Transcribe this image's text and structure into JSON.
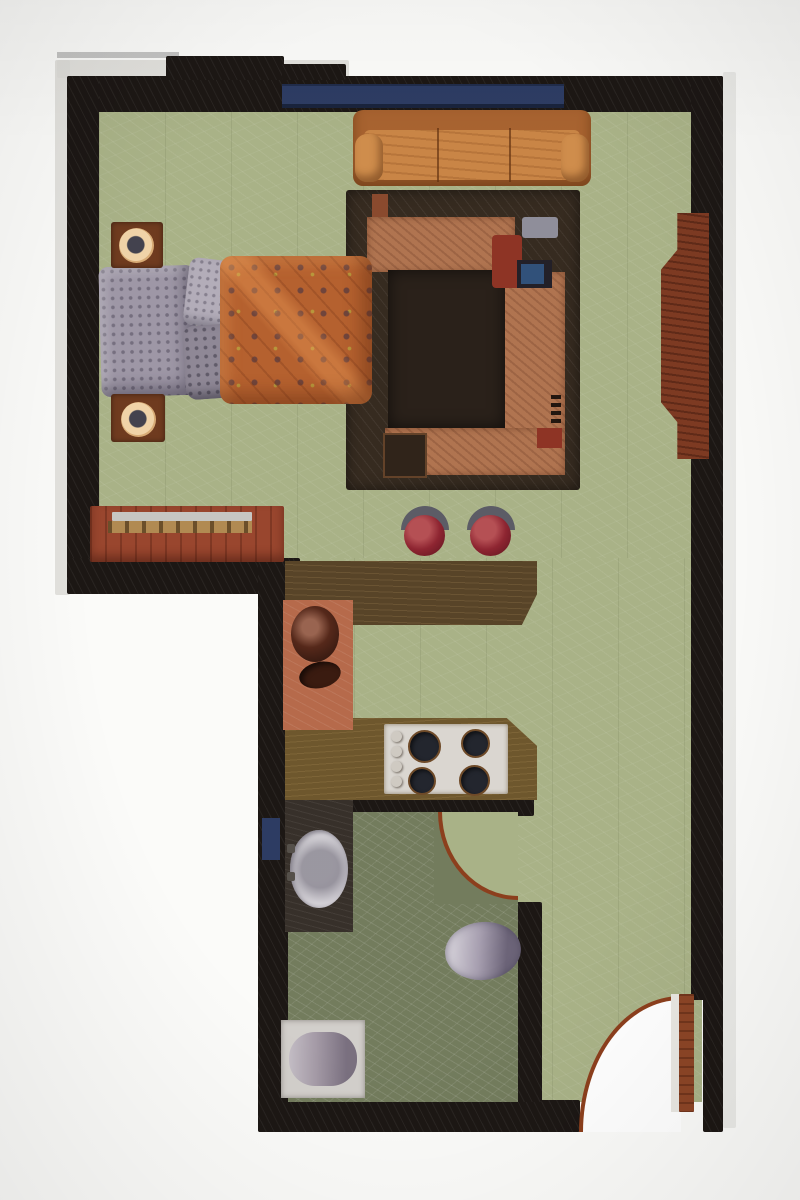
{
  "meta": {
    "title": "Studio apartment floor plan — illustrated top-down view (photographed print, no text labels visible)"
  },
  "palette": {
    "page": "#fbfbf9",
    "paper_edge": "#dddcd8",
    "wall": "#1c1714",
    "window_band": "#2d3c63",
    "floor_main": "#a9b287",
    "floor_bath": "#737c5d",
    "couch": "#c98546",
    "couch_dark": "#a5berr",
    "couch_base": "#a express",
    "couch_frame": "#a86330",
    "couch_arm": "#cf8d4c",
    "rug_base": "#362b20",
    "rug_inner": "#2a211a",
    "sectional": "#b07450",
    "rug_post": "#8a4a2e",
    "rug_table": "#30241a",
    "tv_frame": "#232028",
    "tv_screen": "#31517a",
    "accent_red": "#8e3425",
    "accent_gray": "#8f8e9a",
    "bed_blanket": "#b5612f",
    "pillow": "#9e97a6",
    "pillow_light": "#b3adb9",
    "pillow_dark": "#8f8896",
    "nightstand": "#6f3b1f",
    "lamp_ring": "#ecc79b",
    "dresser": "#99462e",
    "dresser_top": "#c7c6c3",
    "dresser_trim": "#b18a52",
    "sideboard": "#7d3a22",
    "bar_counter": "#584428",
    "wood_counter": "#6e572d",
    "sink_counter": "#b66a4b",
    "sink_bowl": "#55281a",
    "sink_drain": "#3a1b10",
    "stove": "#dad6d0",
    "burner": "#23262e",
    "knob": "#cfcac2",
    "stool_seat": "#8e2531",
    "stool_back": "#5c5c66",
    "bath_counter": "#37302a",
    "basin": "#d3d0d6",
    "toilet": "#a79fb0",
    "tub_frame": "#d2cfcb",
    "tub": "#a49aa6",
    "door_leaf": "#8c4526",
    "door_edge": "#e9e7e2",
    "arc_stroke": "#8c3f1d",
    "swing_fill": "#ffffff"
  },
  "rooms": [
    {
      "name": "bedroom",
      "floor": "light sage green"
    },
    {
      "name": "living-area",
      "floor": "light sage green"
    },
    {
      "name": "kitchen",
      "floor": "light sage green with wood counters"
    },
    {
      "name": "bathroom",
      "floor": "dark olive green"
    }
  ],
  "furniture": [
    {
      "name": "double-bed",
      "room": "bedroom"
    },
    {
      "name": "pillows",
      "room": "bedroom"
    },
    {
      "name": "patterned-comforter",
      "room": "bedroom"
    },
    {
      "name": "nightstand-with-lamp",
      "room": "bedroom",
      "count": 2
    },
    {
      "name": "dresser",
      "room": "bedroom"
    },
    {
      "name": "sofa",
      "room": "living-area"
    },
    {
      "name": "area-rug-with-sectional-seating",
      "room": "living-area"
    },
    {
      "name": "tv",
      "room": "living-area"
    },
    {
      "name": "sideboard",
      "room": "living-area"
    },
    {
      "name": "bar-stool",
      "room": "kitchen",
      "count": 2
    },
    {
      "name": "breakfast-bar",
      "room": "kitchen"
    },
    {
      "name": "kitchen-sink",
      "room": "kitchen"
    },
    {
      "name": "cooktop-4-burners",
      "room": "kitchen"
    },
    {
      "name": "vanity-sink",
      "room": "bathroom"
    },
    {
      "name": "toilet",
      "room": "bathroom"
    },
    {
      "name": "bathtub",
      "room": "bathroom"
    },
    {
      "name": "bathroom-door-swing",
      "room": "bathroom"
    },
    {
      "name": "entry-door-swing",
      "room": "living-area"
    },
    {
      "name": "window-band",
      "room": "living-area"
    },
    {
      "name": "bathroom-window",
      "room": "bathroom"
    }
  ]
}
